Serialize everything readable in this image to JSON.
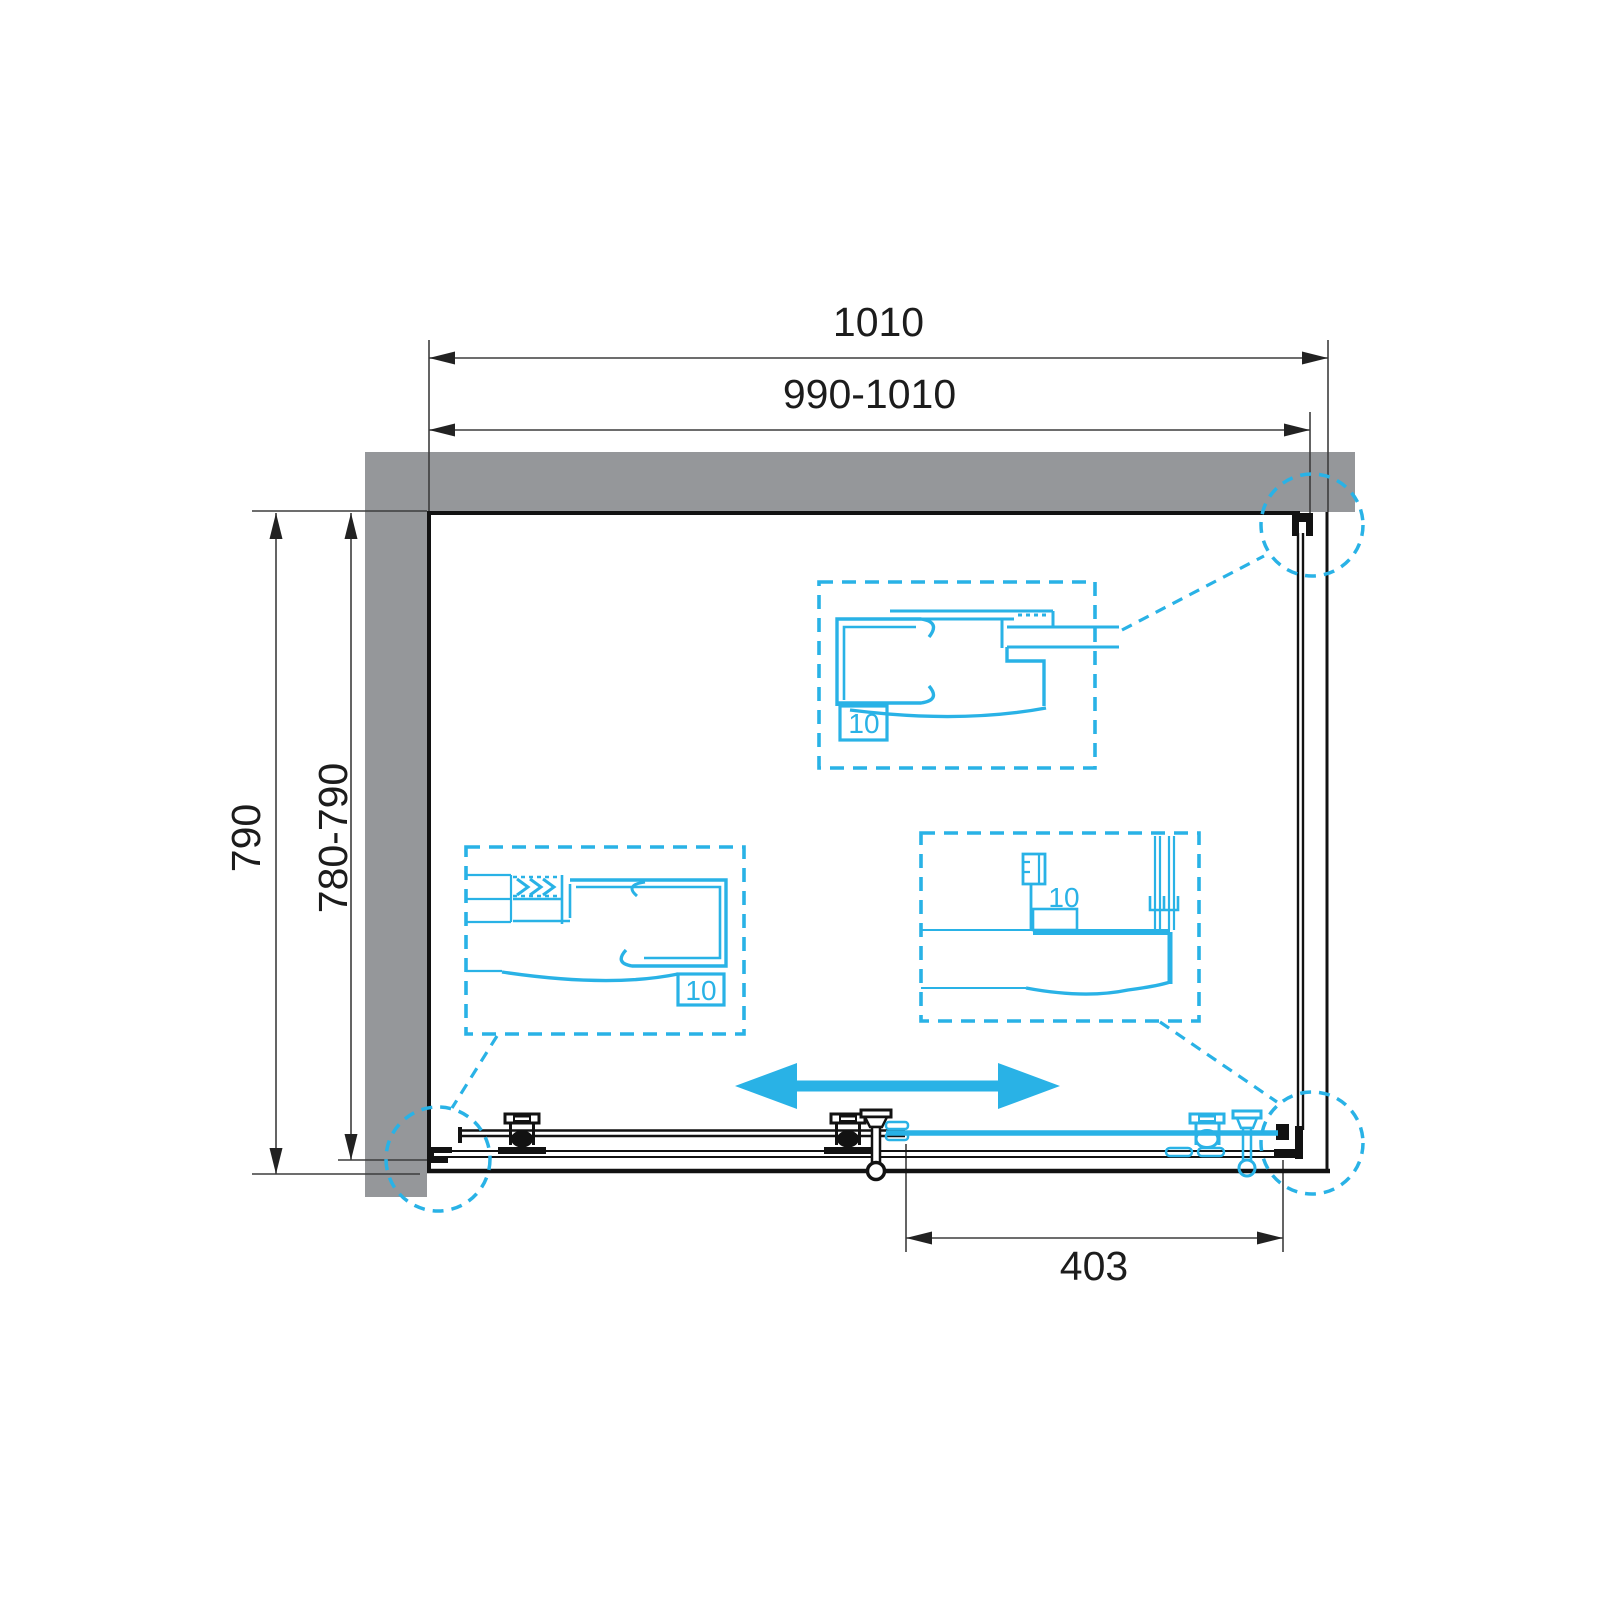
{
  "drawing": {
    "type": "shower-enclosure-plan-view",
    "dimensions": {
      "width_overall": "1010",
      "width_adjustment_range": "990-1010",
      "depth_overall": "790",
      "depth_adjustment_range": "780-790",
      "door_opening_width": "403"
    },
    "glass_thickness": {
      "top_detail": "10",
      "wall_detail": "10",
      "bottom_detail": "10"
    },
    "colors": {
      "accent_cyan": "#29b2e6",
      "wall_gray": "#95979a",
      "line_black": "#121212",
      "dimension_gray": "#3d3d3d"
    }
  }
}
